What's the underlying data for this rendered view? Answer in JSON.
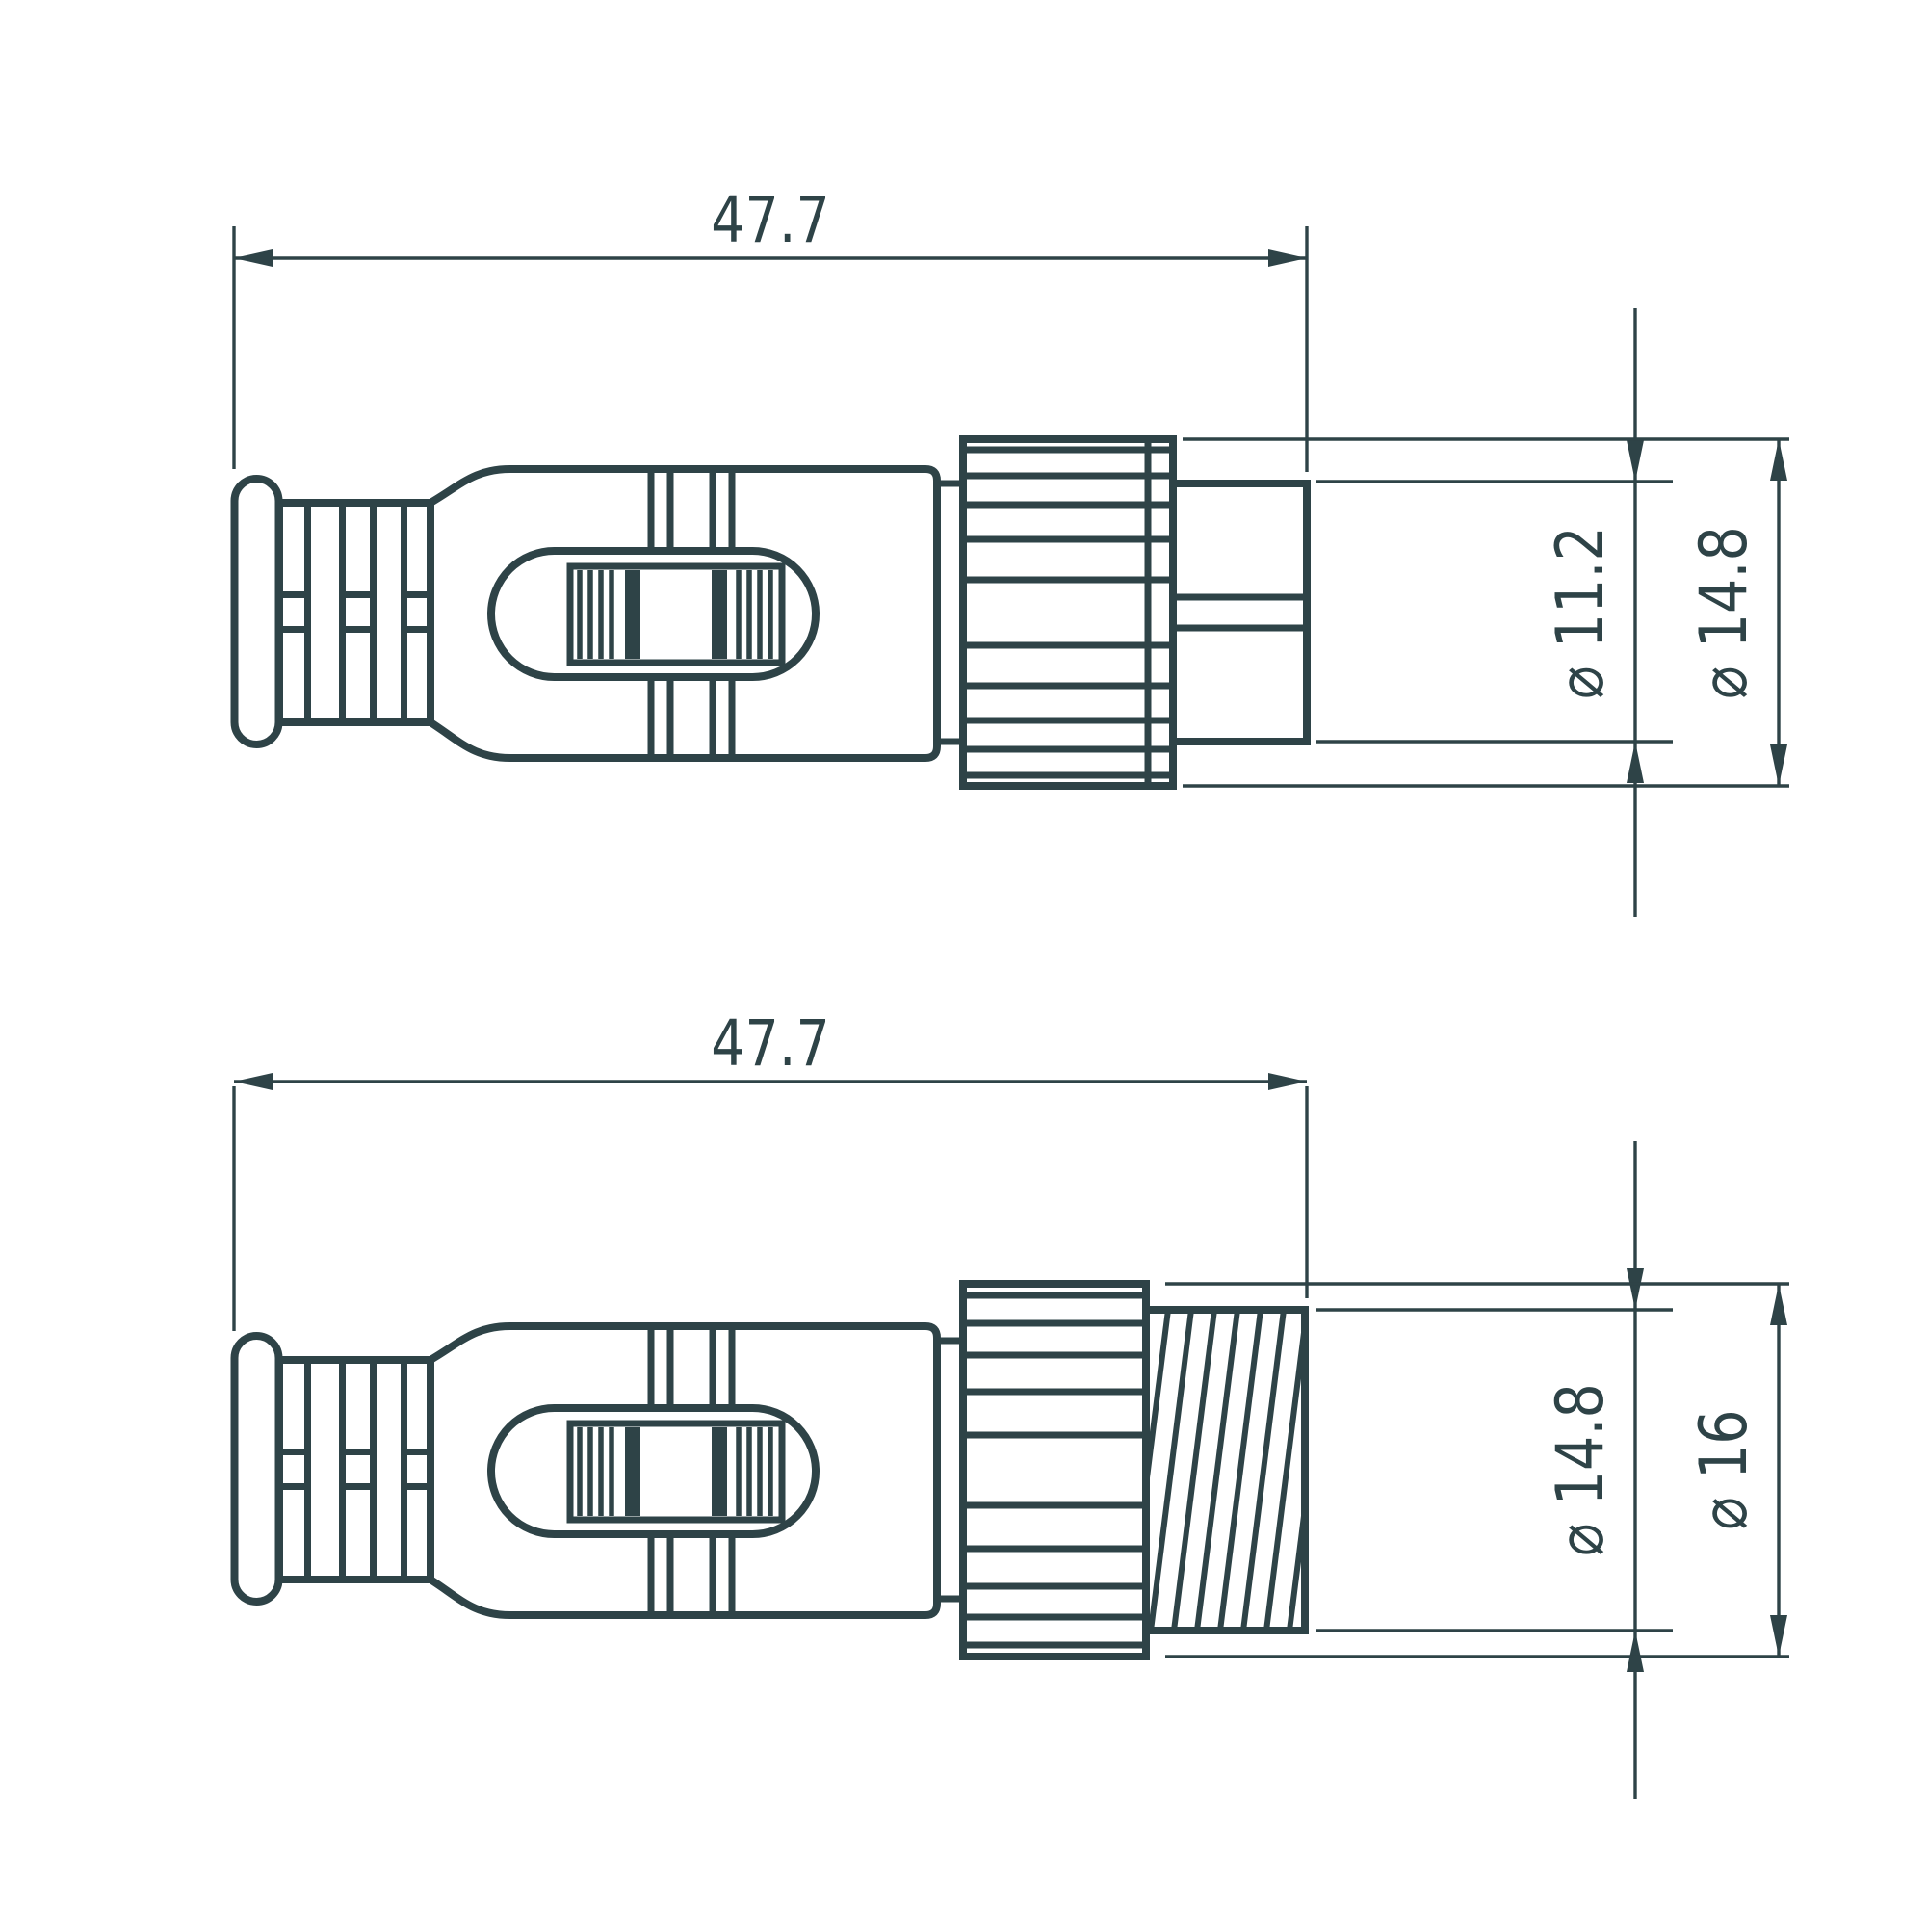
{
  "colors": {
    "ink": "#2E4347",
    "background": "#FFFFFF"
  },
  "views": {
    "top": {
      "length": "47.7",
      "barrel_diameter": "⌀ 11.2",
      "nut_diameter": "⌀ 14.8"
    },
    "bottom": {
      "length": "47.7",
      "thread_diameter": "⌀ 14.8",
      "nut_diameter": "⌀ 16"
    }
  }
}
